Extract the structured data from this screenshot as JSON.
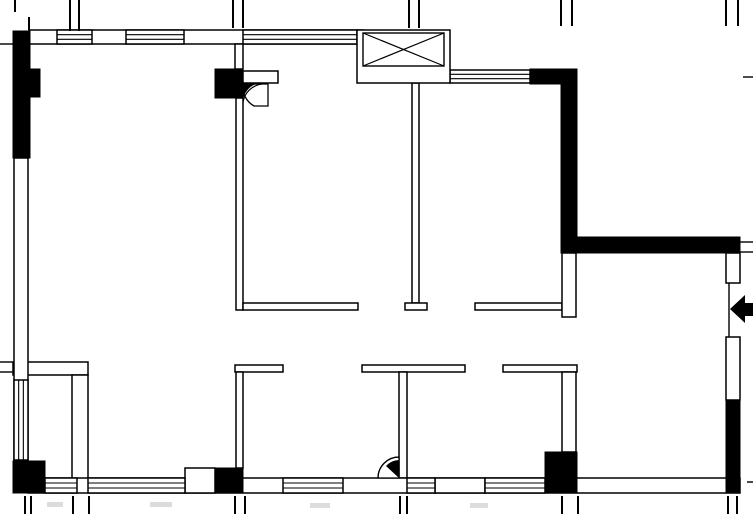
{
  "meta": {
    "title": "Apartment floor plan drawing",
    "canvas": {
      "width": 753,
      "height": 514
    },
    "colors": {
      "background": "#ffffff",
      "ink": "#000000",
      "remnant": "#c0c0c0"
    }
  },
  "plan": {
    "white_walls": [
      {
        "name": "top-exterior-wall",
        "x": 29,
        "y": 30,
        "w": 334,
        "h": 14
      },
      {
        "name": "wall-pier-below-top-wall",
        "x": 235,
        "y": 44,
        "w": 8,
        "h": 25
      },
      {
        "name": "interior-wall-vertical-left-of-living",
        "x": 236,
        "y": 98,
        "w": 7,
        "h": 212
      },
      {
        "name": "mid-wall-left-segment",
        "x": 243,
        "y": 303,
        "w": 115,
        "h": 7
      },
      {
        "name": "elevator-stem-wall",
        "x": 412,
        "y": 83,
        "w": 7,
        "h": 220
      },
      {
        "name": "elevator-stem-cap",
        "x": 405,
        "y": 303,
        "w": 22,
        "h": 7
      },
      {
        "name": "mid-wall-right-segment",
        "x": 475,
        "y": 303,
        "w": 87,
        "h": 7
      },
      {
        "name": "hall-wall-vertical",
        "x": 562,
        "y": 253,
        "w": 14,
        "h": 64
      },
      {
        "name": "right-wall-above-entry",
        "x": 726,
        "y": 253,
        "w": 14,
        "h": 30
      },
      {
        "name": "right-wall-below-entry",
        "x": 726,
        "y": 337,
        "w": 14,
        "h": 63
      },
      {
        "name": "bottom-room-divider-stub",
        "x": 235,
        "y": 365,
        "w": 48,
        "h": 7
      },
      {
        "name": "bottom-room-divider-vertical-1",
        "x": 236,
        "y": 372,
        "w": 7,
        "h": 96
      },
      {
        "name": "bottom-room-t-wall",
        "x": 362,
        "y": 365,
        "w": 103,
        "h": 7
      },
      {
        "name": "bottom-room-divider-vertical-2",
        "x": 399,
        "y": 372,
        "w": 8,
        "h": 106
      },
      {
        "name": "bottom-room-l-wall",
        "x": 503,
        "y": 365,
        "w": 74,
        "h": 7
      },
      {
        "name": "bottom-room-divider-vertical-3",
        "x": 562,
        "y": 372,
        "w": 14,
        "h": 80
      },
      {
        "name": "left-balcony-wall-horizontal",
        "x": 13,
        "y": 362,
        "w": 75,
        "h": 13
      },
      {
        "name": "left-balcony-wall-vertical",
        "x": 72,
        "y": 375,
        "w": 16,
        "h": 105
      },
      {
        "name": "left-exterior-wall",
        "x": 14,
        "y": 158,
        "w": 14,
        "h": 303
      },
      {
        "name": "closet-stub-near-column",
        "x": 243,
        "y": 71,
        "w": 35,
        "h": 12
      },
      {
        "name": "bottom-exterior-wall",
        "x": 28,
        "y": 478,
        "w": 712,
        "h": 15
      },
      {
        "name": "bottom-wall-pier",
        "x": 185,
        "y": 468,
        "w": 30,
        "h": 25
      },
      {
        "name": "bottom-wall-plain-segment",
        "x": 435,
        "y": 478,
        "w": 50,
        "h": 15
      }
    ],
    "windows": [
      {
        "name": "window-top-1",
        "x": 57,
        "y": 30,
        "w": 35,
        "h": 14,
        "orient": "h"
      },
      {
        "name": "window-top-2",
        "x": 126,
        "y": 30,
        "w": 58,
        "h": 14,
        "orient": "h"
      },
      {
        "name": "window-top-3",
        "x": 243,
        "y": 30,
        "w": 114,
        "h": 14,
        "orient": "h"
      },
      {
        "name": "window-top-right",
        "x": 450,
        "y": 70,
        "w": 80,
        "h": 13,
        "orient": "h"
      },
      {
        "name": "window-left-balcony",
        "x": 14,
        "y": 380,
        "w": 14,
        "h": 80,
        "orient": "v"
      },
      {
        "name": "window-bottom-1",
        "x": 45,
        "y": 478,
        "w": 32,
        "h": 15,
        "orient": "h"
      },
      {
        "name": "window-bottom-2",
        "x": 88,
        "y": 478,
        "w": 97,
        "h": 15,
        "orient": "h"
      },
      {
        "name": "window-bottom-3",
        "x": 283,
        "y": 478,
        "w": 60,
        "h": 15,
        "orient": "h"
      },
      {
        "name": "window-bottom-4",
        "x": 407,
        "y": 478,
        "w": 28,
        "h": 15,
        "orient": "h"
      },
      {
        "name": "window-bottom-5",
        "x": 485,
        "y": 478,
        "w": 60,
        "h": 15,
        "orient": "h"
      }
    ],
    "black_walls": [
      {
        "name": "column-top-left",
        "x": 13,
        "y": 31,
        "w": 17,
        "h": 127
      },
      {
        "name": "column-top-left-bump",
        "x": 30,
        "y": 69,
        "w": 10,
        "h": 28
      },
      {
        "name": "column-top-center",
        "x": 215,
        "y": 69,
        "w": 28,
        "h": 29
      },
      {
        "name": "shear-wall-top-horizontal",
        "x": 530,
        "y": 69,
        "w": 47,
        "h": 15
      },
      {
        "name": "shear-wall-vertical",
        "x": 561,
        "y": 69,
        "w": 16,
        "h": 184
      },
      {
        "name": "shear-wall-long-horizontal",
        "x": 561,
        "y": 237,
        "w": 179,
        "h": 16
      },
      {
        "name": "column-right-bottom",
        "x": 726,
        "y": 400,
        "w": 14,
        "h": 93
      },
      {
        "name": "column-bottom-left",
        "x": 13,
        "y": 461,
        "w": 32,
        "h": 32
      },
      {
        "name": "column-bottom-center",
        "x": 215,
        "y": 468,
        "w": 28,
        "h": 25
      },
      {
        "name": "column-bottom-right",
        "x": 545,
        "y": 452,
        "w": 32,
        "h": 41
      }
    ],
    "elevator": {
      "name": "elevator-shaft",
      "outer": {
        "x": 357,
        "y": 30,
        "w": 93,
        "h": 53
      },
      "inner": {
        "x": 363,
        "y": 33,
        "w": 81,
        "h": 33
      }
    },
    "doors": [
      {
        "name": "door-top-center",
        "panel": "M243,84 L268,84 L268,106 L254,106 A22,22 0 0 1 243,84 Z",
        "arc": "M262,84 A22,22 0 0 0 243,102",
        "leaf": "M243,84 L256,84 A20,20 0 0 0 243,100 Z"
      },
      {
        "name": "door-bottom-center",
        "panel": "M399,478 L378,478 A21,21 0 0 1 399,457 Z",
        "arc": "M378,478 A21,21 0 0 1 399,457",
        "leaf": "M399,478 L399,460 A18,18 0 0 0 386,466 Z"
      }
    ],
    "entry_arrow": {
      "name": "entry-direction-arrow",
      "points": "730,309 745,295 745,303 753,303 753,316 745,316 745,323"
    },
    "thin_lines": [
      {
        "name": "entry-opening-jamb-line",
        "x1": 729,
        "y1": 283,
        "x2": 729,
        "y2": 337,
        "w": 1.4
      },
      {
        "name": "edge-tick-left-top",
        "x1": 0,
        "y1": 44,
        "x2": 13,
        "y2": 44,
        "w": 1.4
      },
      {
        "name": "edge-tick-left-mid-1",
        "x1": 0,
        "y1": 362,
        "x2": 13,
        "y2": 362,
        "w": 1.4
      },
      {
        "name": "edge-tick-left-mid-2",
        "x1": 0,
        "y1": 372,
        "x2": 13,
        "y2": 372,
        "w": 1.4
      },
      {
        "name": "edge-tick-right-top",
        "x1": 743,
        "y1": 77,
        "x2": 753,
        "y2": 77,
        "w": 1.4
      },
      {
        "name": "edge-tick-right-mid-1",
        "x1": 740,
        "y1": 242,
        "x2": 753,
        "y2": 242,
        "w": 1.4
      },
      {
        "name": "edge-tick-right-mid-2",
        "x1": 740,
        "y1": 252,
        "x2": 753,
        "y2": 252,
        "w": 1.4
      },
      {
        "name": "edge-tick-right-bottom",
        "x1": 747,
        "y1": 482,
        "x2": 753,
        "y2": 482,
        "w": 1.4
      },
      {
        "name": "grid-stub-top-corner",
        "x1": 15,
        "y1": 0,
        "x2": 15,
        "y2": 12,
        "w": 2
      },
      {
        "name": "grid-stub-top-wall-edge",
        "x1": 29,
        "y1": 17,
        "x2": 29,
        "y2": 30,
        "w": 2
      },
      {
        "name": "grid-stub-top-a1",
        "x1": 70,
        "y1": 0,
        "x2": 70,
        "y2": 31,
        "w": 2
      },
      {
        "name": "grid-stub-top-a2",
        "x1": 79,
        "y1": 0,
        "x2": 79,
        "y2": 31,
        "w": 2
      },
      {
        "name": "grid-stub-top-b1",
        "x1": 233,
        "y1": 0,
        "x2": 233,
        "y2": 28,
        "w": 2
      },
      {
        "name": "grid-stub-top-b2",
        "x1": 243,
        "y1": 0,
        "x2": 243,
        "y2": 28,
        "w": 2
      },
      {
        "name": "grid-stub-top-c1",
        "x1": 409,
        "y1": 0,
        "x2": 409,
        "y2": 28,
        "w": 2
      },
      {
        "name": "grid-stub-top-c2",
        "x1": 419,
        "y1": 0,
        "x2": 419,
        "y2": 28,
        "w": 2
      },
      {
        "name": "grid-stub-top-d1",
        "x1": 561,
        "y1": 0,
        "x2": 561,
        "y2": 26,
        "w": 2
      },
      {
        "name": "grid-stub-top-d2",
        "x1": 572,
        "y1": 0,
        "x2": 572,
        "y2": 26,
        "w": 2
      },
      {
        "name": "grid-stub-top-e1",
        "x1": 726,
        "y1": 0,
        "x2": 726,
        "y2": 26,
        "w": 2
      },
      {
        "name": "grid-stub-top-e2",
        "x1": 738,
        "y1": 0,
        "x2": 738,
        "y2": 26,
        "w": 2
      },
      {
        "name": "grid-stub-bottom-a1",
        "x1": 25,
        "y1": 496,
        "x2": 25,
        "y2": 514,
        "w": 2
      },
      {
        "name": "grid-stub-bottom-a2",
        "x1": 31,
        "y1": 496,
        "x2": 31,
        "y2": 514,
        "w": 2
      },
      {
        "name": "grid-stub-bottom-b1",
        "x1": 73,
        "y1": 496,
        "x2": 73,
        "y2": 514,
        "w": 2
      },
      {
        "name": "grid-stub-bottom-b2",
        "x1": 89,
        "y1": 496,
        "x2": 89,
        "y2": 514,
        "w": 2
      },
      {
        "name": "grid-stub-bottom-c1",
        "x1": 235,
        "y1": 496,
        "x2": 235,
        "y2": 514,
        "w": 2
      },
      {
        "name": "grid-stub-bottom-c2",
        "x1": 245,
        "y1": 496,
        "x2": 245,
        "y2": 514,
        "w": 2
      },
      {
        "name": "grid-stub-bottom-d1",
        "x1": 400,
        "y1": 496,
        "x2": 400,
        "y2": 514,
        "w": 2
      },
      {
        "name": "grid-stub-bottom-d2",
        "x1": 407,
        "y1": 496,
        "x2": 407,
        "y2": 514,
        "w": 2
      },
      {
        "name": "grid-stub-bottom-e1",
        "x1": 562,
        "y1": 496,
        "x2": 562,
        "y2": 514,
        "w": 2
      },
      {
        "name": "grid-stub-bottom-e2",
        "x1": 578,
        "y1": 496,
        "x2": 578,
        "y2": 514,
        "w": 2
      },
      {
        "name": "grid-stub-bottom-f1",
        "x1": 728,
        "y1": 496,
        "x2": 728,
        "y2": 514,
        "w": 2
      },
      {
        "name": "grid-stub-bottom-f2",
        "x1": 737,
        "y1": 496,
        "x2": 737,
        "y2": 514,
        "w": 2
      }
    ],
    "remnants": [
      {
        "name": "dimension-text-remnant",
        "x": 47,
        "y": 502,
        "w": 16,
        "h": 5
      },
      {
        "name": "dimension-text-remnant",
        "x": 150,
        "y": 502,
        "w": 22,
        "h": 5
      },
      {
        "name": "dimension-text-remnant",
        "x": 310,
        "y": 503,
        "w": 20,
        "h": 5
      },
      {
        "name": "dimension-text-remnant",
        "x": 470,
        "y": 503,
        "w": 18,
        "h": 5
      }
    ]
  }
}
